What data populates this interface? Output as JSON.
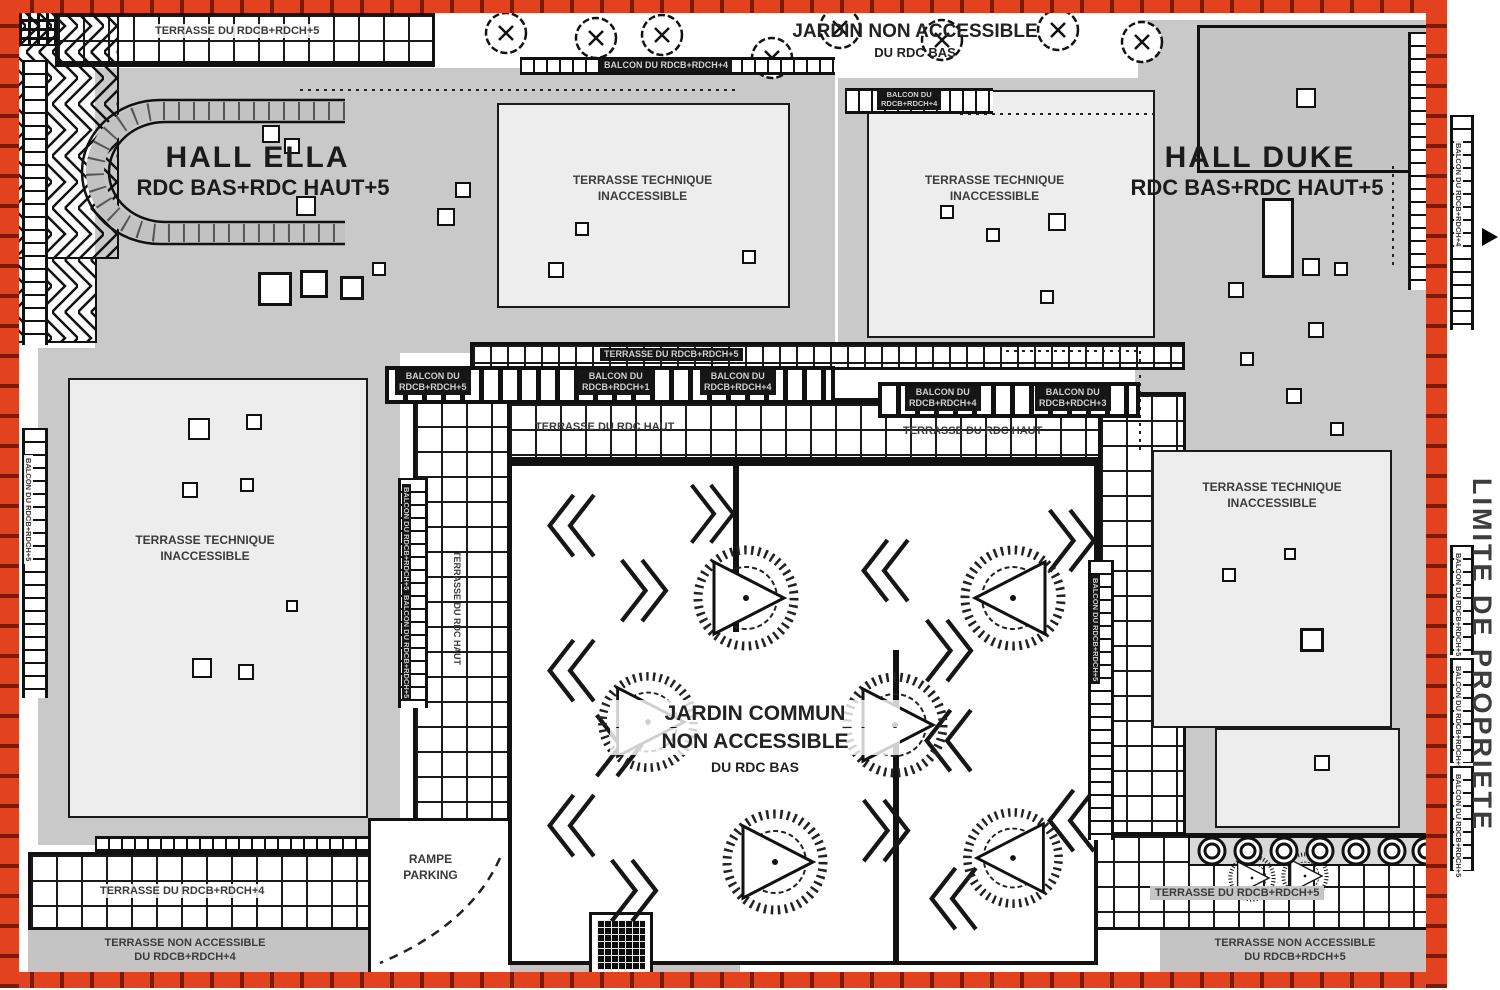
{
  "colors": {
    "property_line_red": "#e2421f",
    "building_gray": "#c9c9c9",
    "terrace_light": "#ededed",
    "line_black": "#111111"
  },
  "property_line": {
    "label": "LIMITE DE PROPRIETE"
  },
  "halls": {
    "ella": {
      "name": "HALL ELLA",
      "levels": "RDC BAS+RDC HAUT+5"
    },
    "duke": {
      "name": "HALL DUKE",
      "levels": "RDC BAS+RDC HAUT+5"
    }
  },
  "jardin_top": {
    "line1": "JARDIN NON ACCESSIBLE",
    "line2": "DU RDC BAS"
  },
  "jardin_commun": {
    "line1": "JARDIN COMMUN",
    "line2": "NON ACCESSIBLE",
    "line3": "DU RDC BAS"
  },
  "terrasse_technique": {
    "line1": "TERRASSE TECHNIQUE",
    "line2": "INACCESSIBLE"
  },
  "terraces": {
    "top_left": "TERRASSE DU RDCB+RDCH+5",
    "middle": "TERRASSE DU RDCB+RDCH+5",
    "rdc_haut_left": "TERRASSE DU RDC HAUT",
    "rdc_haut_right": "TERRASSE DU RDC HAUT",
    "rdc_haut_vertical": "TERRASSE DU RDC HAUT",
    "bottom_left": "TERRASSE DU RDCB+RDCH+4",
    "bottom_right": "TERRASSE DU RDCB+RDCH+5",
    "non_accessible_left": {
      "line1": "TERRASSE NON ACCESSIBLE",
      "line2": "DU RDCB+RDCH+4"
    },
    "non_accessible_right": {
      "line1": "TERRASSE NON ACCESSIBLE",
      "line2": "DU RDCB+RDCH+5"
    }
  },
  "balcons": {
    "top_center": "BALCON DU RDCB+RDCH+4",
    "upper_small": {
      "line1": "BALCON DU",
      "line2": "RDCB+RDCH+4"
    },
    "row_left_5": {
      "line1": "BALCON DU",
      "line2": "RDCB+RDCH+5"
    },
    "row_center_1": {
      "line1": "BALCON DU",
      "line2": "RDCB+RDCH+1"
    },
    "row_center_4": {
      "line1": "BALCON DU",
      "line2": "RDCB+RDCH+4"
    },
    "row_right_4": {
      "line1": "BALCON DU",
      "line2": "RDCB+RDCH+4"
    },
    "row_right_3": {
      "line1": "BALCON DU",
      "line2": "RDCB+RDCH+3"
    },
    "left_edge": "BALCON DU RDCB+RDCH+5",
    "inner_left_col": "BALCON DU RDCB+RDCH+5",
    "inner_right_col": "BALCON DU RDCB+RDCH+5",
    "right_edge_top": "BALCON DU RDCB+RDCH+4",
    "right_edge_mid1": "BALCON DU RDCB+RDCH+5",
    "right_edge_mid2": "BALCON DU RDCB+RDCH+5",
    "right_edge_bottom": "BALCON DU RDCB+RDCH+5"
  },
  "rampe": {
    "line1": "RAMPE",
    "line2": "PARKING"
  }
}
